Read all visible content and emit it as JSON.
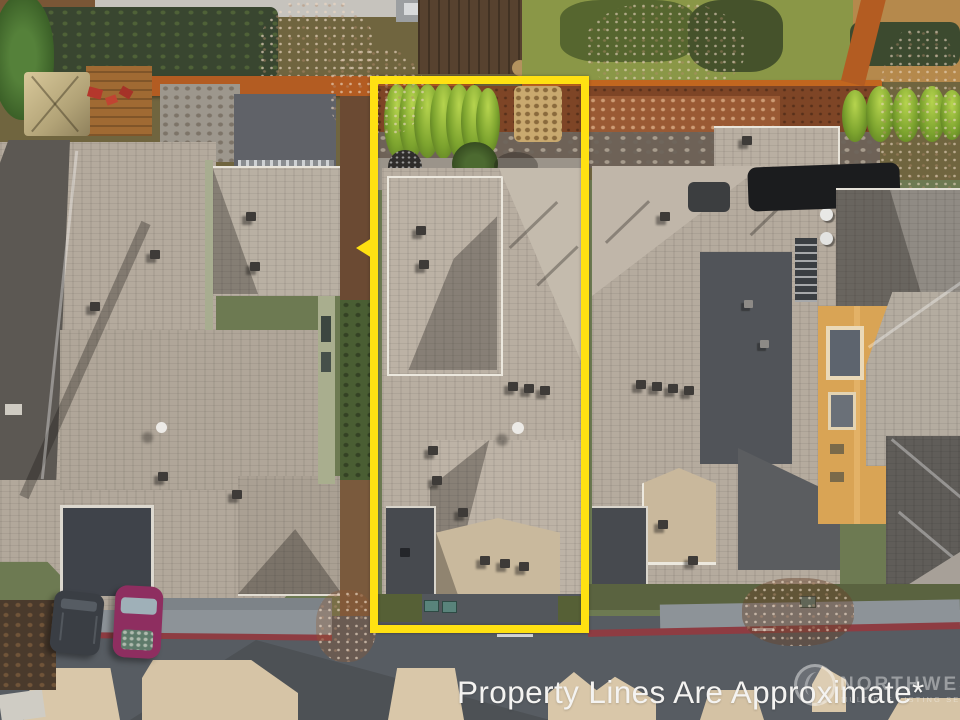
{
  "caption": {
    "text": "Property Lines Are Approximate*"
  },
  "watermark": {
    "line1": "NORTHWEST",
    "line2": "MULTIPLE LISTING SERVICE",
    "logo": "nwmls-circle-logo"
  },
  "property_outline": {
    "shape": "rectangle",
    "color": "#ffe112"
  },
  "palette": {
    "roof_light": "#b8aea1",
    "roof_shadow": "#5c5853",
    "flat_roof_dark": "#474a4f",
    "porch_tan": "#c9b89c",
    "road_asphalt": "#575c62",
    "sidewalk": "#8d9398",
    "curb_red": "#8e3c42",
    "driveway_tan": "#d9c7a9",
    "fence_orange": "#b35c22",
    "mulch_brown": "#7e4526",
    "lawn_moss": "#8a9747",
    "hedge_dark": "#39462e",
    "arborvitae_green": "#7ca32e",
    "stucco_orange": "#d9a455",
    "car_magenta": "#8e2e60",
    "car_dark_suv": "#3a3e44",
    "caption_white": "#f4f3f1"
  }
}
